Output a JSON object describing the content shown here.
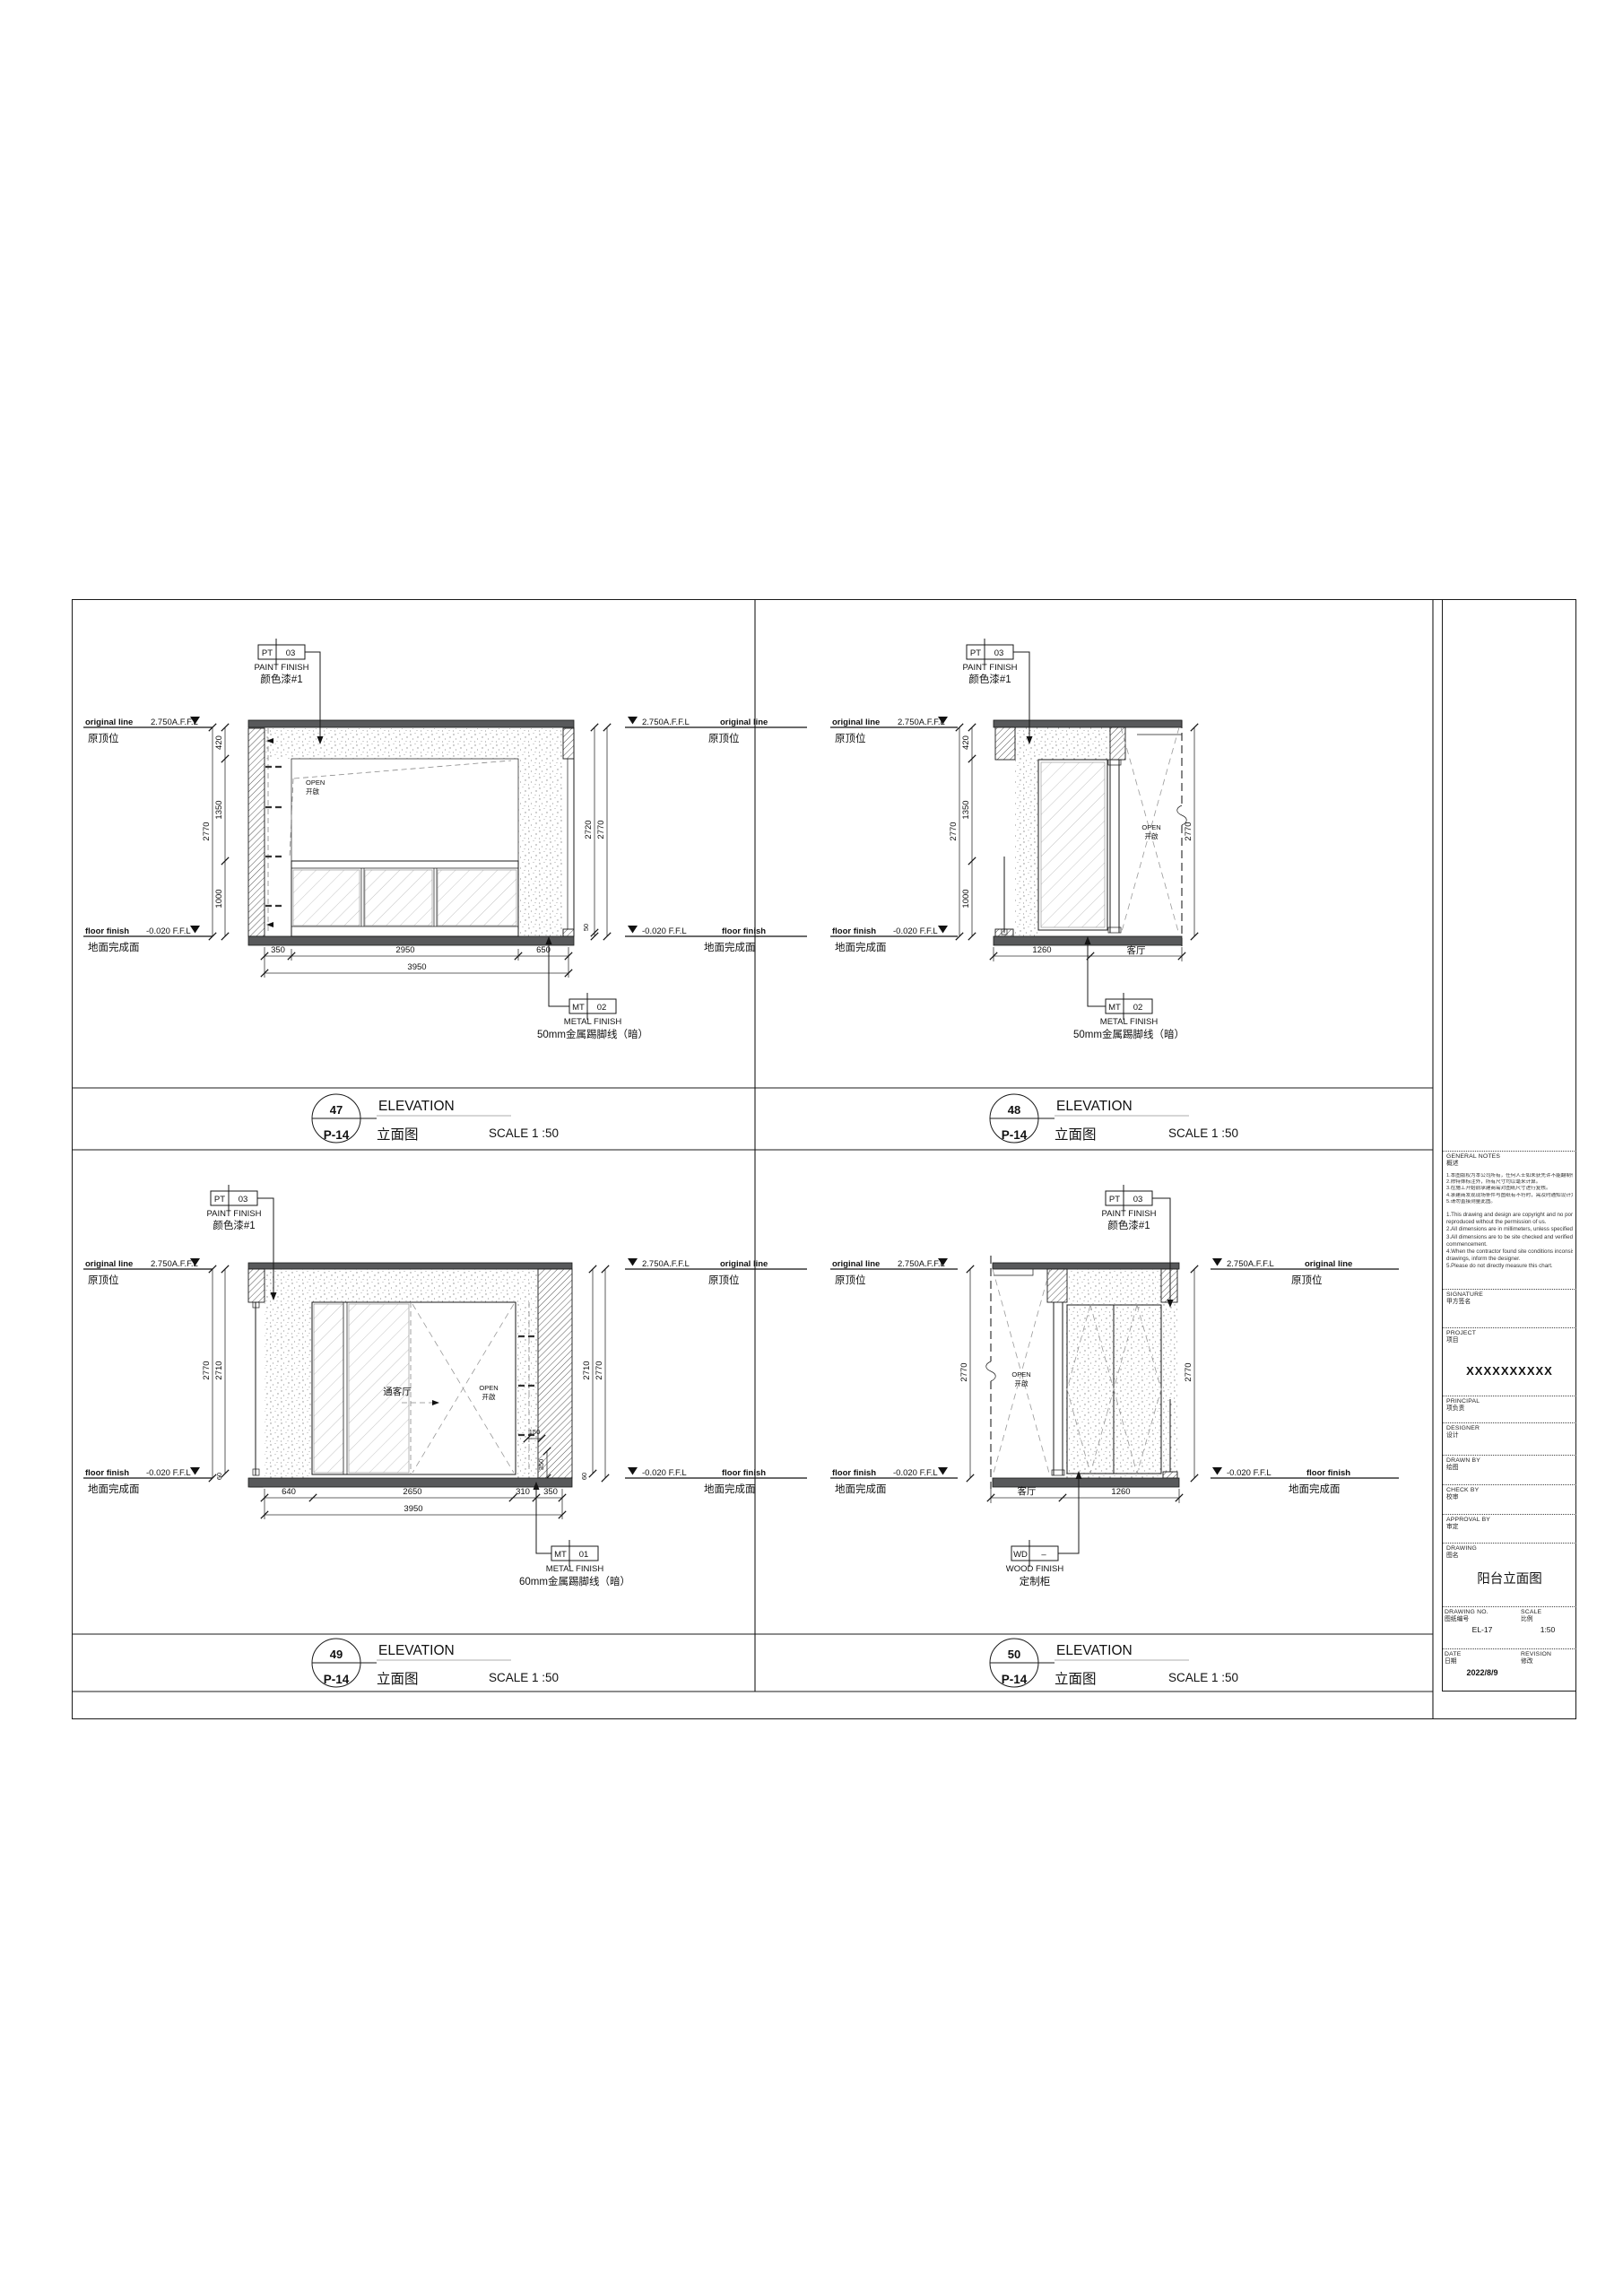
{
  "levels": {
    "top_en": "original line",
    "top_val": "2.750A.F.F.L",
    "top_cn": "原顶位",
    "bot_en": "floor finish",
    "bot_val": "-0.020 F.F.L",
    "bot_cn": "地面完成面"
  },
  "open_label": {
    "en": "OPEN",
    "cn": "开啟"
  },
  "labels": {
    "living_room": "客厅",
    "to_living": "通客厅"
  },
  "tags": {
    "pt03": {
      "code": "PT",
      "num": "03",
      "en": "PAINT FINISH",
      "cn": "颜色漆#1"
    },
    "mt02": {
      "code": "MT",
      "num": "02",
      "en": "METAL FINISH",
      "cn": "50mm金属踢脚线（暗）"
    },
    "mt01": {
      "code": "MT",
      "num": "01",
      "en": "METAL FINISH",
      "cn": "60mm金属踢脚线（暗）"
    },
    "wd": {
      "code": "WD",
      "num": "–",
      "en": "WOOD FINISH",
      "cn": "定制柜"
    }
  },
  "titlebar": {
    "en": "ELEVATION",
    "cn": "立面图",
    "scale": "SCALE 1 :50",
    "ref": "P-14"
  },
  "views": {
    "v47": "47",
    "v48": "48",
    "v49": "49",
    "v50": "50"
  },
  "dims": {
    "e47": {
      "h2770": "2770",
      "h420": "420",
      "h1350": "1350",
      "h1000": "1000",
      "h2720": "2720",
      "h50": "50",
      "b350": "350",
      "b2950": "2950",
      "b650": "650",
      "b3950": "3950"
    },
    "e48": {
      "h2770": "2770",
      "h420": "420",
      "h1350": "1350",
      "h1000": "1000",
      "hr2770": "2770",
      "b1260": "1260"
    },
    "e49": {
      "h2770": "2770",
      "h2710": "2710",
      "h60": "60",
      "hr2710": "2710",
      "hr2770": "2770",
      "hr60": "60",
      "b640": "640",
      "b2650": "2650",
      "b310": "310",
      "b350": "350",
      "b3950": "3950",
      "m150": "150",
      "m350": "350"
    },
    "e50": {
      "hl2770": "2770",
      "hr2770": "2770",
      "b1260": "1260"
    }
  },
  "titleblock": {
    "general_notes_en": "GENERAL NOTES",
    "general_notes_cn": "概述",
    "notes_cn": [
      "1.本图版权为本公司所有，任何人士如未获先许不能翻制作任何部分。",
      "2.除特殊标注外，所有尺寸均以毫米计算。",
      "3.在施工开始前承建商需对图纸尺寸进行复核。",
      "4.承建商发现现场条件与图纸有不符时，需及时通知设计方。",
      "5.请勿直接测量此图。"
    ],
    "notes_en": [
      "1.This drawing and design are copyright and no portion may be",
      "   reproduced without the permission of us.",
      "2.All dimensions are in millimeters, unless specified otherwise.",
      "3.All dimensions are to be site checked and verified prior to",
      "   commencement.",
      "4.When the contractor found site conditions inconsistent with",
      "   drawings, inform the designer.",
      "5.Please do not directly measure this chart."
    ],
    "signature_en": "SIGNATURE",
    "signature_cn": "甲方签名",
    "project_en": "PROJECT",
    "project_cn": "项目",
    "project_value": "XXXXXXXXXX",
    "principal_en": "PRINCIPAL",
    "principal_cn": "项负责",
    "designer_en": "DESIGNER",
    "designer_cn": "设计",
    "drawn_en": "DRAWN BY",
    "drawn_cn": "绘图",
    "check_en": "CHECK BY",
    "check_cn": "校审",
    "approval_en": "APPROVAL BY",
    "approval_cn": "审定",
    "drawing_en": "DRAWING",
    "drawing_cn": "图名",
    "drawing_value": "阳台立面图",
    "no_en": "DRAWING NO.",
    "no_cn": "图纸编号",
    "no_value": "EL-17",
    "scale_en": "SCALE",
    "scale_cn": "比例",
    "scale_value": "1:50",
    "date_en": "DATE",
    "date_cn": "日期",
    "date_value": "2022/8/9",
    "revision_en": "REVISION",
    "revision_cn": "修改"
  }
}
